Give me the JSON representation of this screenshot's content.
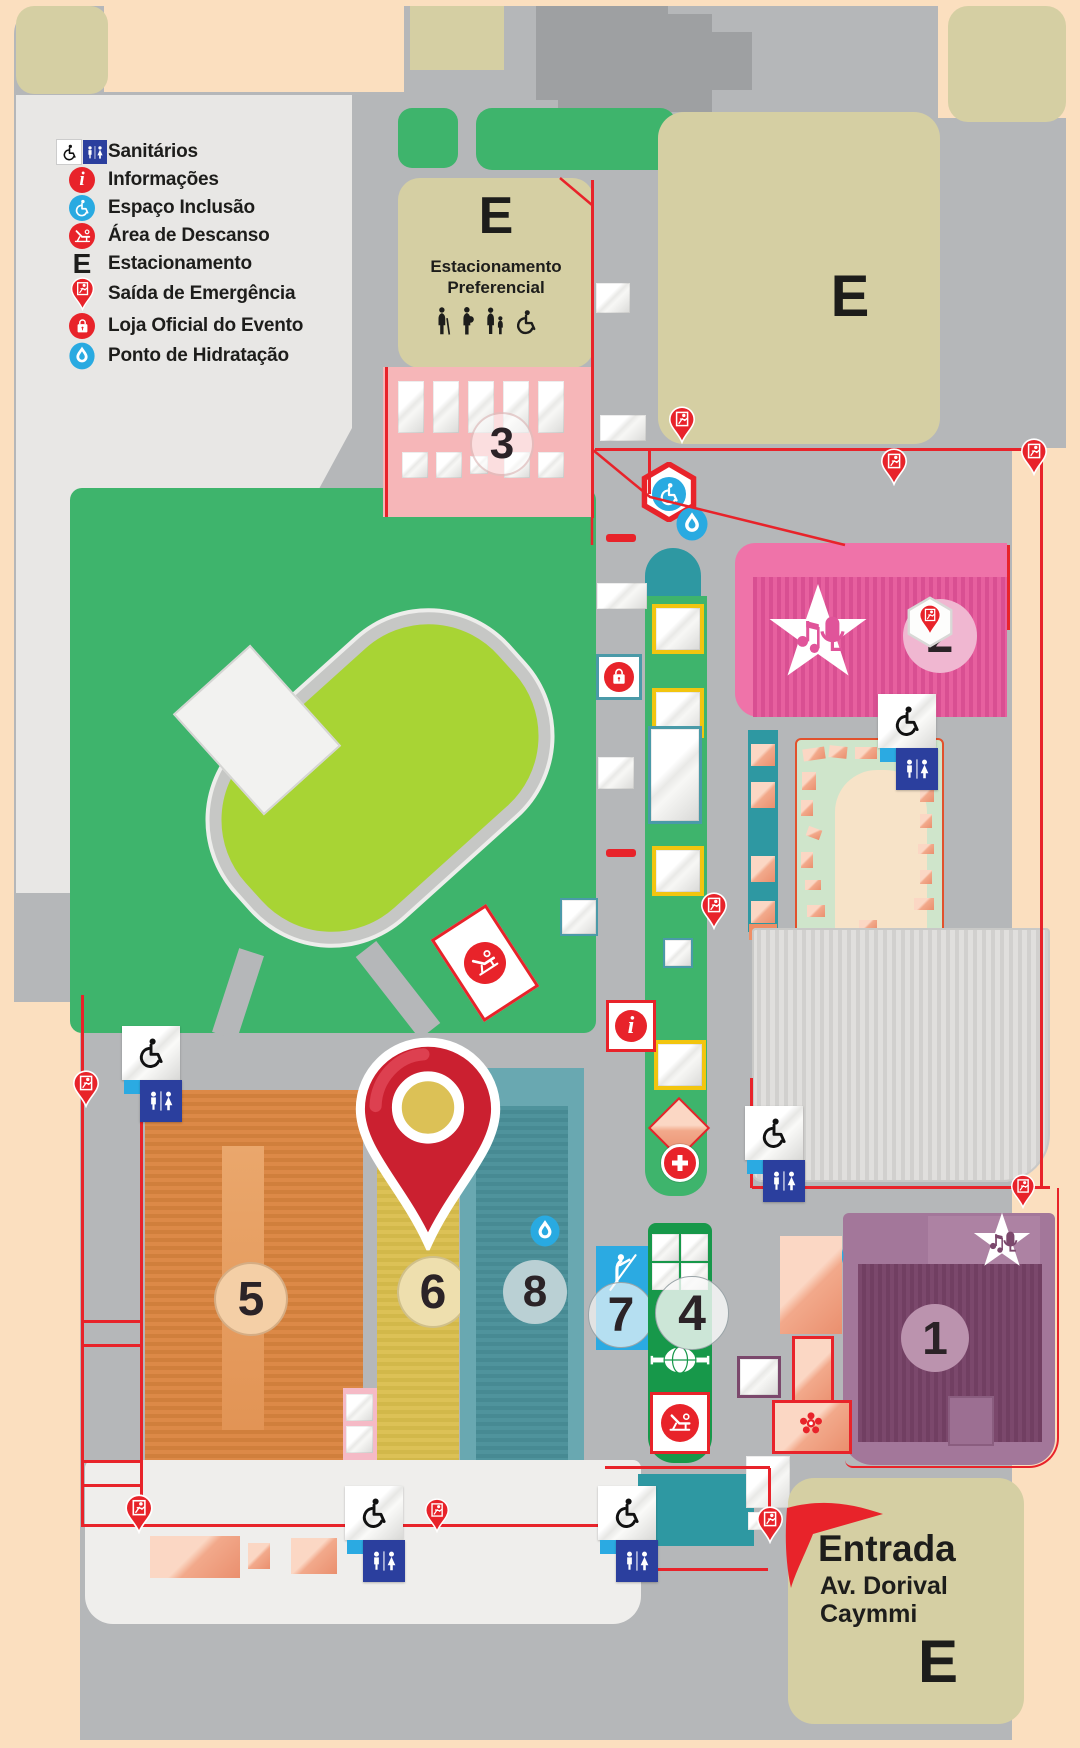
{
  "legend": {
    "items": [
      {
        "label": "Sanitários",
        "icon": "restroom-icons"
      },
      {
        "label": "Informações",
        "icon": "info-icon"
      },
      {
        "label": "Espaço Inclusão",
        "icon": "wheelchair-icon"
      },
      {
        "label": "Área de Descanso",
        "icon": "lounge-chair-icon"
      },
      {
        "label": "Estacionamento",
        "icon": "letter-e"
      },
      {
        "label": "Saída de Emergência",
        "icon": "emergency-exit-pin-icon"
      },
      {
        "label": "Loja Oficial do Evento",
        "icon": "shopping-bag-icon"
      },
      {
        "label": "Ponto de Hidratação",
        "icon": "water-drop-icon"
      }
    ]
  },
  "parking": {
    "letter": "E",
    "preferential_line1": "Estacionamento",
    "preferential_line2": "Preferencial"
  },
  "entrance": {
    "title": "Entrada",
    "street_line1": "Av. Dorival",
    "street_line2": "Caymmi"
  },
  "areas": {
    "a1": "1",
    "a2": "2",
    "a3": "3",
    "a4": "4",
    "a5": "5",
    "a6": "6",
    "a7": "7",
    "a8": "8"
  },
  "icons": {
    "info_glyph": "i"
  },
  "colors": {
    "map_red": "#e8232a",
    "road_gray": "#b5b7b9",
    "khaki": "#d5cfa3",
    "grass_green": "#3eb46c",
    "field_lime": "#a8d434",
    "stage_pink": "#ef73a9",
    "area1_purple": "#7b486c",
    "inclusion_blue": "#29aae1",
    "restroom_blue": "#2b3f9e",
    "marker_red": "#cb2030"
  }
}
